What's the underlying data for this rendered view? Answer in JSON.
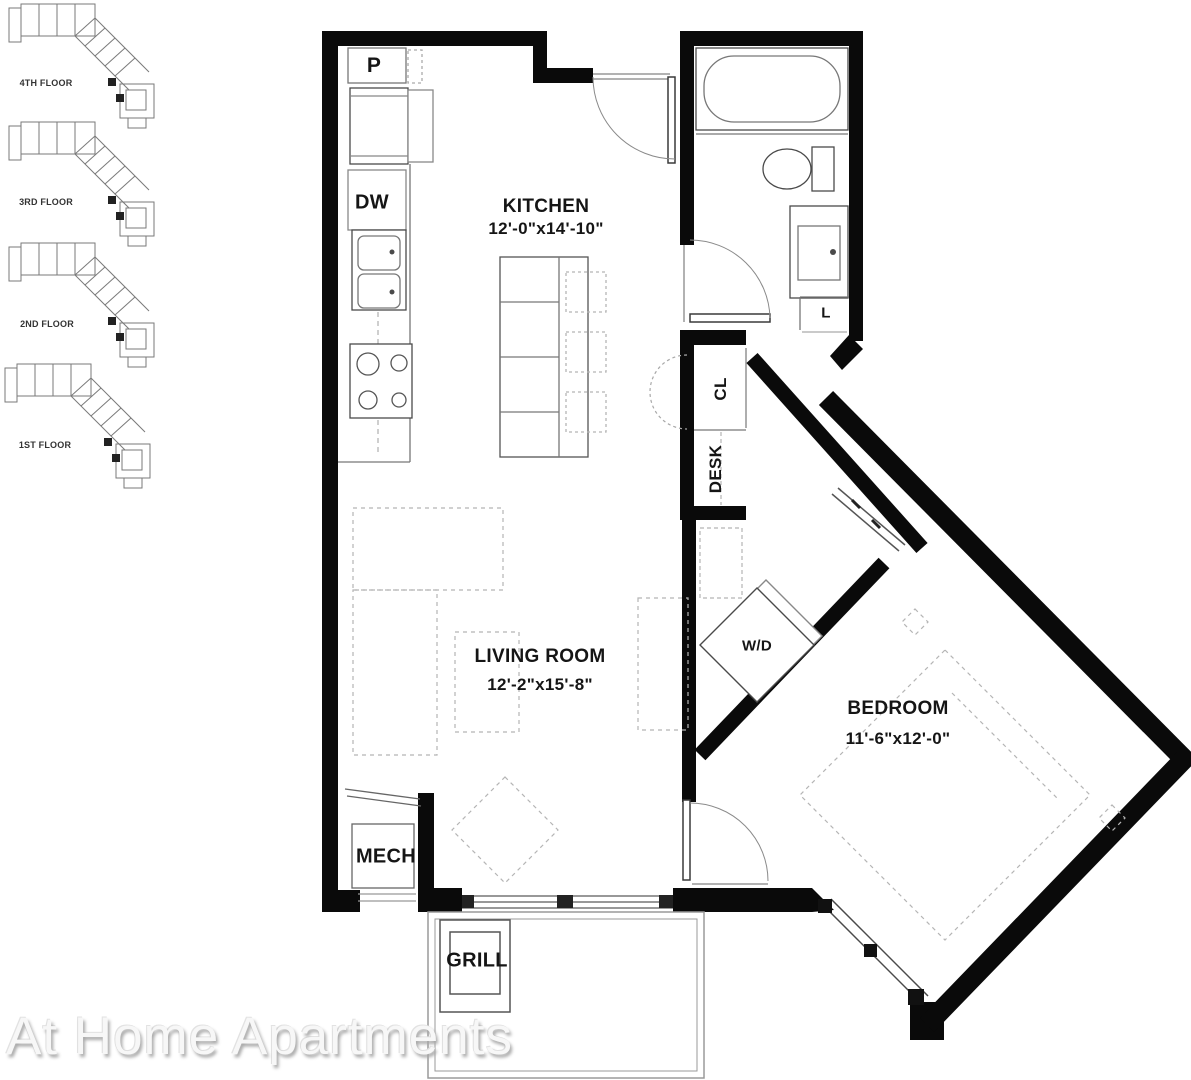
{
  "floorplan": {
    "watermark": "At Home Apartments",
    "floors": [
      {
        "label": "4TH FLOOR"
      },
      {
        "label": "3RD FLOOR"
      },
      {
        "label": "2ND FLOOR"
      },
      {
        "label": "1ST FLOOR"
      }
    ],
    "rooms": {
      "kitchen": {
        "name": "KITCHEN",
        "dims": "12'-0\"x14'-10\""
      },
      "living_room": {
        "name": "LIVING ROOM",
        "dims": "12'-2\"x15'-8\""
      },
      "bedroom": {
        "name": "BEDROOM",
        "dims": "11'-6\"x12'-0\""
      }
    },
    "labels": {
      "pantry": "P",
      "dishwasher": "DW",
      "closet": "CL",
      "desk": "DESK",
      "washer_dryer": "W/D",
      "linen": "L",
      "mechanical": "MECH",
      "grill": "GRILL"
    },
    "colors": {
      "wall": "#0a0a0a",
      "fixture_line": "#4a4a4a",
      "light_line": "#999999",
      "dashed": "#a8a8a8",
      "watermark_text": "#f7f7f7"
    }
  }
}
